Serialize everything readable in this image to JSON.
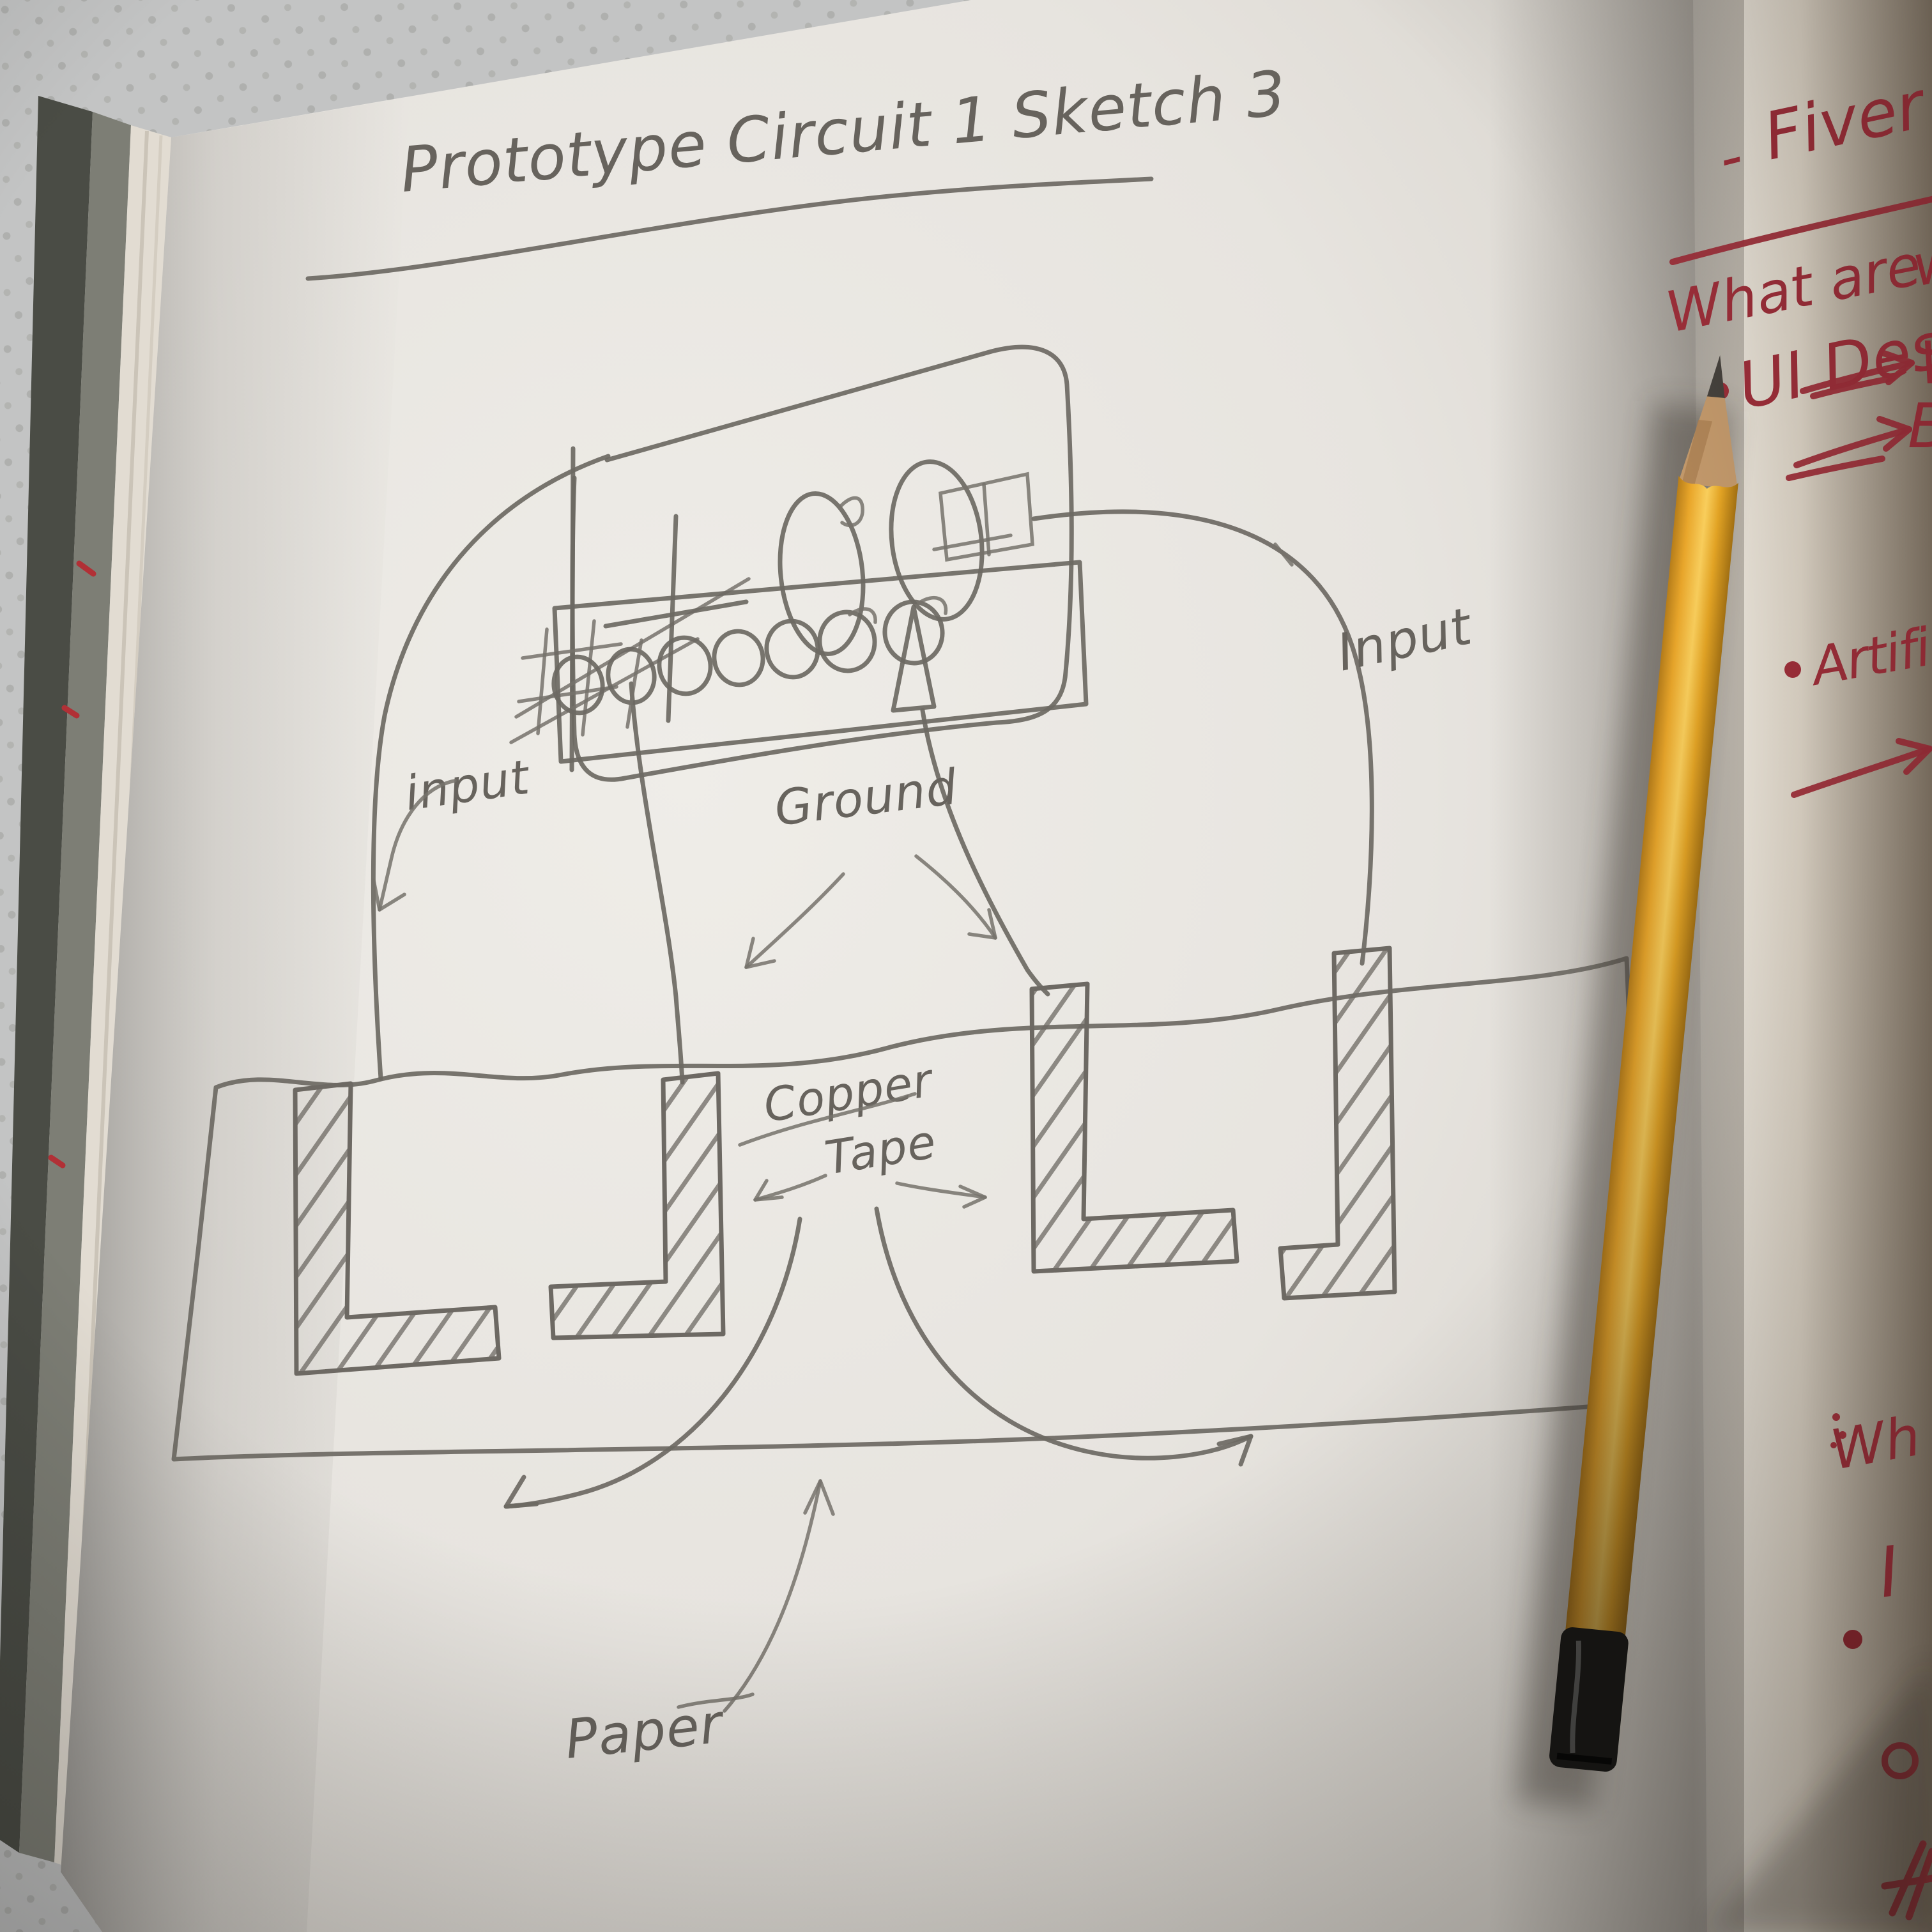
{
  "sketch": {
    "title": "Prototype Circuit 1 Sketch 3",
    "labels": {
      "input_left": "input",
      "ground": "Ground",
      "input_right": "Input",
      "copper_line1": "Copper",
      "copper_line2": "Tape",
      "paper": "Paper"
    }
  },
  "notes": {
    "dash": "-",
    "fiver": "Fiver",
    "what_are": "What are",
    "what_are_partial": "w",
    "ui": "UI Des",
    "w": "W",
    "b": "B",
    "artificial": "Artifi",
    "wh": "Wh",
    "i": "I"
  },
  "icons": {
    "pin_circles": "7 header pin circles",
    "ground_arrows": "down-left and down-right arrows",
    "copper_arrows": "down-left and down-right arrows",
    "paper_arrow": "curved up arrow",
    "pad_link_arrows": "two curved arrows under copper pads",
    "note_arrows": "red right arrows",
    "red_circle_doodle": "small red ring",
    "red_scribble": "red hatch scribble",
    "pencil": "yellow pencil with black ferrule"
  },
  "colors": {
    "graphite": "#6d6963",
    "red_ink": "#9e2f3a",
    "pencil_yellow": "#eda92b",
    "pencil_wood": "#c49a6c",
    "paper_white": "#e9e6e1",
    "right_page": "#efe9df",
    "fabric": "#c3c4c4",
    "cover_dark": "#4a4c45"
  }
}
